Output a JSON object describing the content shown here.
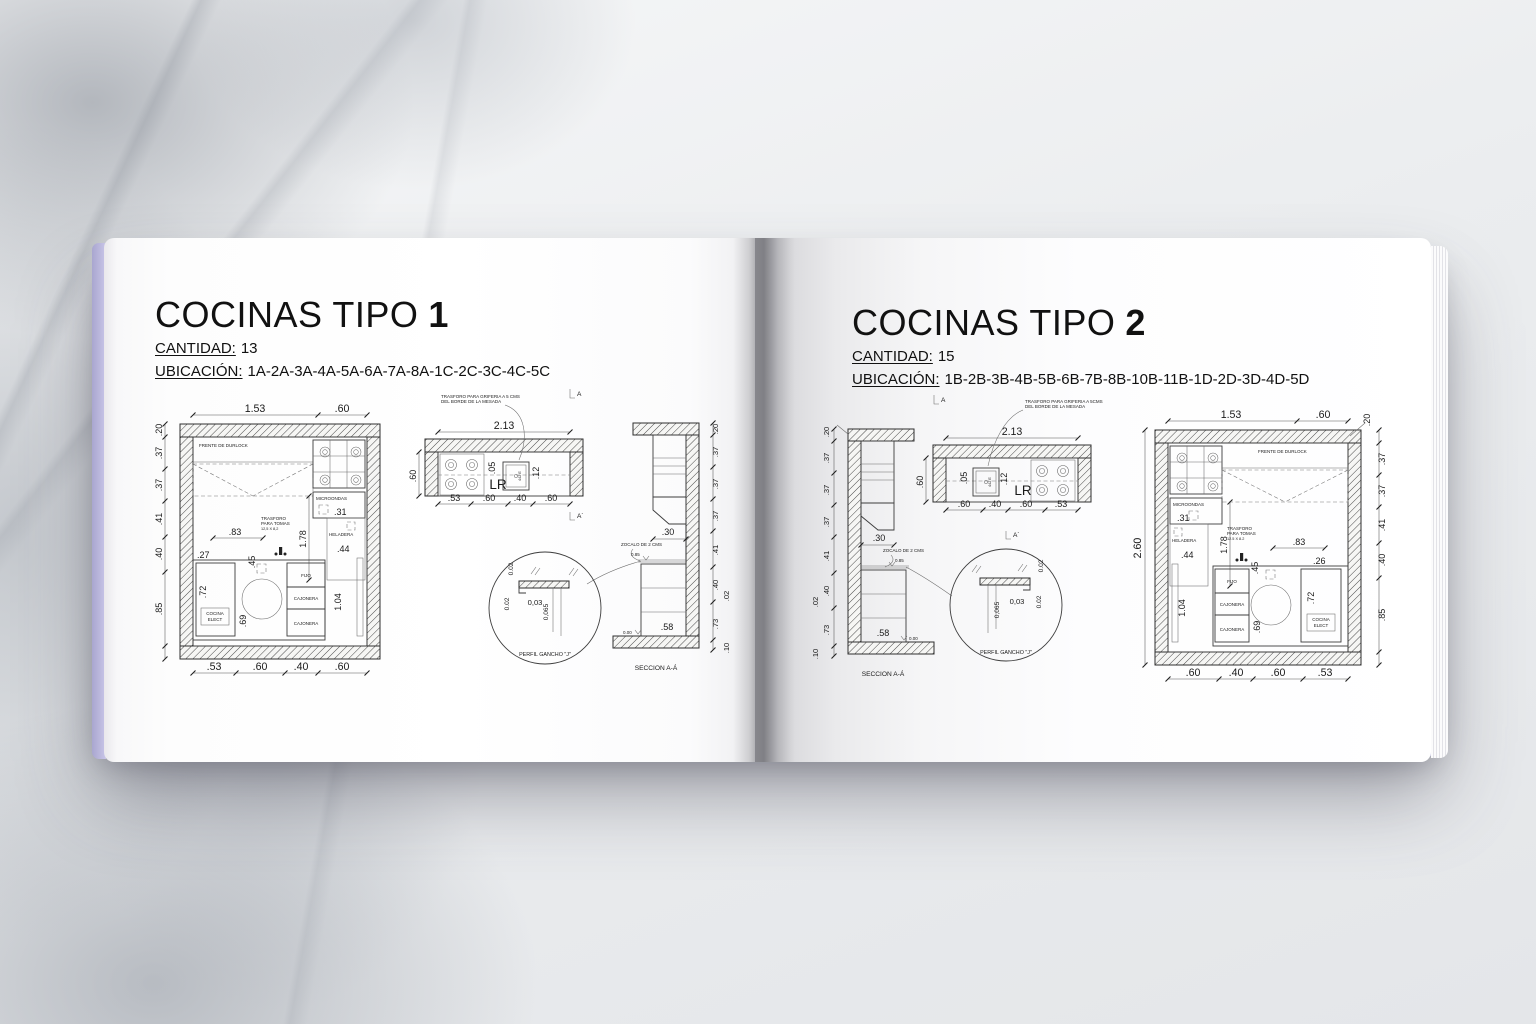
{
  "colors": {
    "cover_edge": "#c4c1e4",
    "page": "#ffffff",
    "line": "#3c3c3c",
    "background": "#e9ebee"
  },
  "book": {
    "left_page": {
      "title": "COCINAS TIPO",
      "title_number": "1",
      "cantidad_label": "CANTIDAD:",
      "cantidad_value": "13",
      "ubicacion_label": "UBICACIÓN:",
      "ubicacion_value": "1A-2A-3A-4A-5A-6A-7A-8A-1C-2C-3C-4C-5C",
      "plan": {
        "top_dims": [
          "1.53",
          ".60"
        ],
        "wall_dim": ".20",
        "side_dims": [
          ".37",
          ".37",
          ".41",
          ".40",
          ".85"
        ],
        "bottom_dims": [
          ".53",
          ".60",
          ".40",
          ".60"
        ],
        "frente_label": "FRENTE DE DURLOCK",
        "microondas_label": "MICROONDAS",
        "microondas_dim": ".31",
        "alto_dim": "1.78",
        "heladera_label": "HELADERA",
        "heladera_dim": ".44",
        "trasforo_line1": "TRASFORO",
        "trasforo_line2": "PARA TOMAS",
        "trasforo_line3": "12,5 X 8,2",
        "trasforo_dim": ".83",
        "mesada_dim": ".27",
        "pileta_dim": ".45",
        "cocina_dim": ".72",
        "cocina_line1": "COCINA",
        "cocina_line2": "ELECT",
        "circulo_dim": ".69",
        "fijo_label": "FIJO",
        "cajonera_label": "CAJONERA",
        "cajonera_label2": "CAJONERA",
        "puerta_dim": "1.04"
      },
      "counter": {
        "note_line1": "TRASFORO PARA GRIFERIA A 5 CMS",
        "note_line2": "DEL BORDE DE LA MESADA",
        "section_marker_top": "A",
        "section_marker_bottom": "A´",
        "total_dim": "2.13",
        "depth_dim": ".60",
        "gap_dim": ".05",
        "sink_label": "442 E",
        "edge_dim": ".12",
        "lr_label": "LR",
        "bottom_dims": [
          ".53",
          ".60",
          ".40",
          ".60"
        ]
      },
      "section": {
        "alacena_dim": ".30",
        "zocalo_note": "ZOCALO DE 2 CMS",
        "level_top": "0.85",
        "level_zero": "0.00",
        "cajon_dim": ".58",
        "side_dims": [
          ".20",
          ".37",
          ".37",
          ".37",
          ".41",
          ".40",
          ".02",
          ".73",
          ".10"
        ],
        "caption": "SECCION A-Á"
      },
      "detail": {
        "dim_a": "0.02",
        "dim_b": "0.02",
        "dim_c": "0,03",
        "dim_d": "0,065",
        "caption": "PERFIL GANCHO \"J\""
      }
    },
    "right_page": {
      "title": "COCINAS TIPO",
      "title_number": "2",
      "cantidad_label": "CANTIDAD:",
      "cantidad_value": "15",
      "ubicacion_label": "UBICACIÓN:",
      "ubicacion_value": "1B-2B-3B-4B-5B-6B-7B-8B-10B-11B-1D-2D-3D-4D-5D",
      "plan": {
        "top_dims": [
          "1.53",
          ".60"
        ],
        "wall_dim": ".20",
        "overall_dim": "2.60",
        "side_dims": [
          ".37",
          ".37",
          ".41",
          ".40",
          ".85"
        ],
        "bottom_dims": [
          ".60",
          ".40",
          ".60",
          ".53"
        ],
        "frente_label": "FRENTE DE DURLOCK",
        "microondas_label": "MICROONDAS",
        "microondas_dim": ".31",
        "alto_dim": "1.78",
        "heladera_label": "HELADERA",
        "heladera_dim": ".44",
        "trasforo_line1": "TRASFORO",
        "trasforo_line2": "PARA TOMAS",
        "trasforo_line3": "12.5 X 8.2",
        "trasforo_dim": ".83",
        "mesada_dim": ".26",
        "pileta_dim": ".45",
        "cocina_dim": ".72",
        "cocina_line1": "COCINA",
        "cocina_line2": "ELECT",
        "circulo_dim": ".69",
        "fijo_label": "FIJO",
        "cajonera_label": "CAJONERA",
        "cajonera_label2": "CAJONERA",
        "puerta_dim": "1.04"
      },
      "counter": {
        "note_line1": "TRASFORO PARA GRIFERIA A 5CMS",
        "note_line2": "DEL BORDE DE LA MESADA",
        "section_marker_top": "A",
        "section_marker_bottom": "A´",
        "total_dim": "2.13",
        "depth_dim": ".60",
        "gap_dim": ".05",
        "sink_label": "442 E",
        "edge_dim": ".12",
        "lr_label": "LR",
        "bottom_dims": [
          ".60",
          ".40",
          ".60",
          ".53"
        ]
      },
      "section": {
        "alacena_dim": ".30",
        "zocalo_note": "ZOCALO DE 2 CMS",
        "level_top": "0.85",
        "level_zero": "0.00",
        "cajon_dim": ".58",
        "side_dims": [
          ".20",
          ".37",
          ".37",
          ".37",
          ".41",
          ".40",
          ".02",
          ".73",
          ".10"
        ],
        "caption": "SECCION A-Á"
      },
      "detail": {
        "dim_a": "0.02",
        "dim_b": "0.02",
        "dim_c": "0,03",
        "dim_d": "0,065",
        "caption": "PERFIL GANCHO \"J\""
      }
    }
  }
}
